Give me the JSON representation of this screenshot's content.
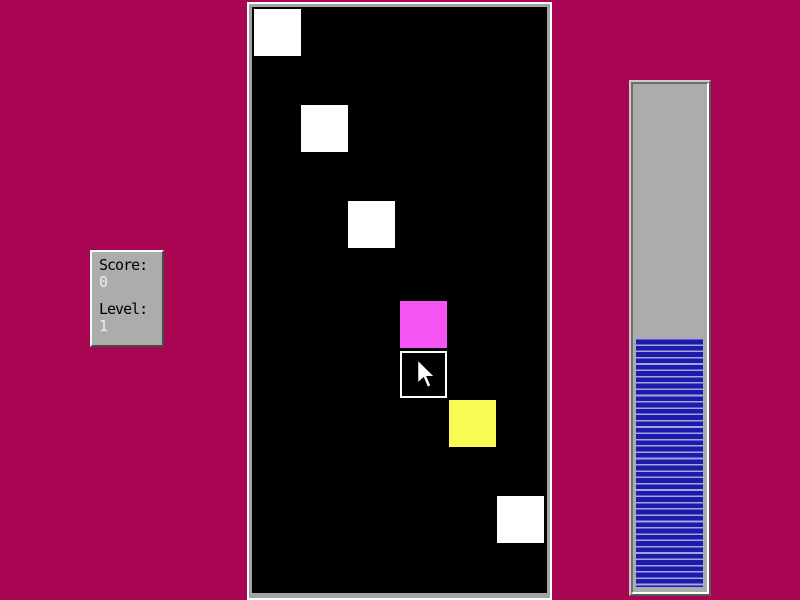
{
  "app": {
    "background_color": "#A80552",
    "board_background": "#000000",
    "frame_gray": "#A3A3A3"
  },
  "score_panel": {
    "background_color": "#ACACAC",
    "score_label": "Score:",
    "score_value": "0",
    "level_label": "Level:",
    "level_value": "1",
    "label_color": "#000000",
    "value_color": "#EDEDED"
  },
  "board": {
    "squares": [
      {
        "x": 2,
        "y": 2,
        "color": "#FFFFFF",
        "name": "white",
        "selected": false
      },
      {
        "x": 49,
        "y": 98,
        "color": "#FFFFFF",
        "name": "white",
        "selected": false
      },
      {
        "x": 96,
        "y": 194,
        "color": "#FFFFFF",
        "name": "white",
        "selected": false
      },
      {
        "x": 148,
        "y": 294,
        "color": "#F454F4",
        "name": "magenta",
        "selected": false
      },
      {
        "x": 148,
        "y": 344,
        "color": "#000000",
        "name": "outlined",
        "selected": true
      },
      {
        "x": 197,
        "y": 393,
        "color": "#FAFA55",
        "name": "yellow",
        "selected": false
      },
      {
        "x": 245,
        "y": 489,
        "color": "#FFFFFF",
        "name": "white",
        "selected": false
      }
    ]
  },
  "meter": {
    "fill_percent": 49,
    "track_color": "#ACACAC",
    "stripe_blue": "#1B1BAC",
    "stripe_light": "#A6A6DC",
    "stripe_period_px": 6.3,
    "stripe_light_px": 1.6
  }
}
